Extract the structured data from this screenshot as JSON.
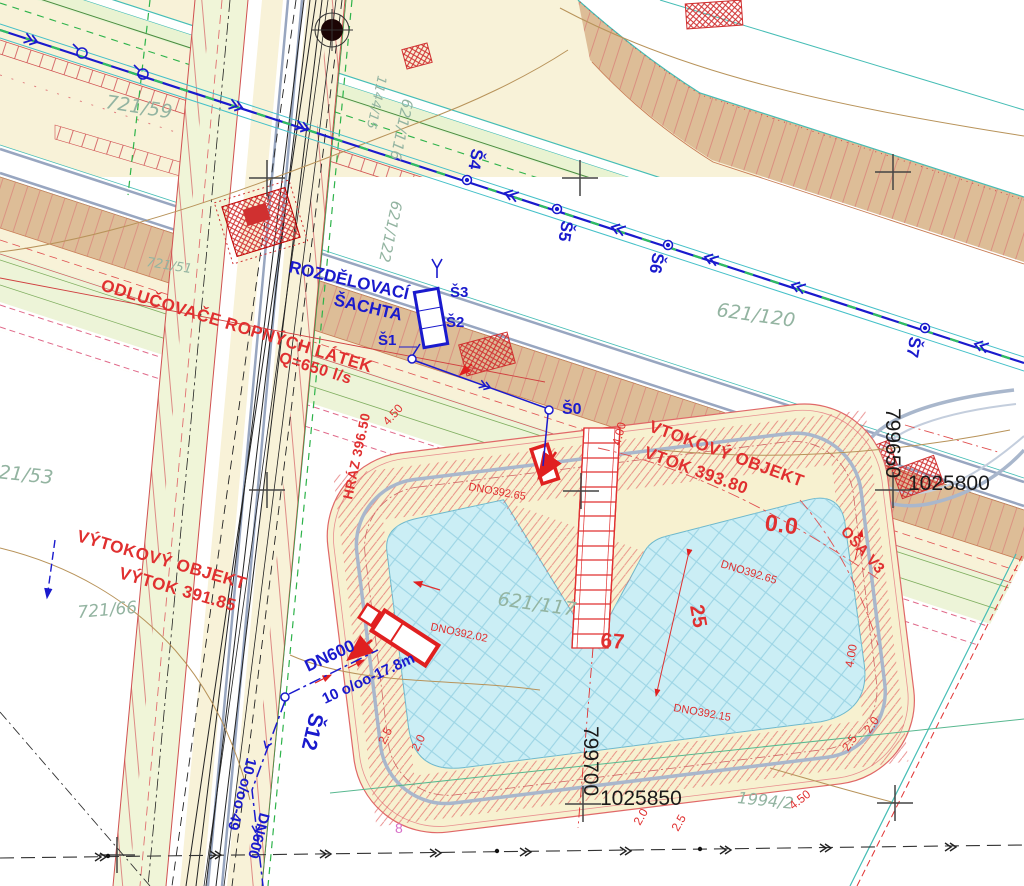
{
  "drawing": {
    "colors": {
      "background": "#ffffff",
      "road_pale_yellow": "#f8f2d8",
      "road_pale_green": "#edf4d8",
      "embankment_tan": "#ddbd97",
      "basin_water": "#cbeef5",
      "basin_hatch": "#9bd4e4",
      "pipe_blue": "#1a1acd",
      "design_red": "#e03030",
      "parcel_green": "#93b4a1",
      "contour_tan": "#b8935a",
      "teal_line": "#45bdb5",
      "grid_black": "#333333"
    },
    "parcels": [
      {
        "text": "721/59"
      },
      {
        "text": "721/51"
      },
      {
        "text": "721/53"
      },
      {
        "text": "721/66"
      },
      {
        "text": "1144/15"
      },
      {
        "text": "621/116"
      },
      {
        "text": "621/122"
      },
      {
        "text": "621/120"
      },
      {
        "text": "621/117"
      },
      {
        "text": "1994/2"
      },
      {
        "text": "8"
      }
    ],
    "shafts": [
      {
        "text": "Š4"
      },
      {
        "text": "Š5"
      },
      {
        "text": "Š6"
      },
      {
        "text": "Š7"
      },
      {
        "text": "Š3"
      },
      {
        "text": "Š2"
      },
      {
        "text": "Š1"
      },
      {
        "text": "Š0"
      },
      {
        "text": "Š12"
      }
    ],
    "blue_notes": [
      {
        "text": "ROZDĚLOVACÍ"
      },
      {
        "text": "ŠACHTA"
      },
      {
        "text": "DN600"
      },
      {
        "text": "10 o/oo-17.8m"
      },
      {
        "text": "10 o/oo-49"
      },
      {
        "text": "DN600"
      }
    ],
    "red_notes": [
      {
        "text": "ODLUČOVAČE ROPNÝCH LÁTEK"
      },
      {
        "text": "Q=650 l/s"
      },
      {
        "text": "VTOKOVÝ OBJEKT"
      },
      {
        "text": "VTOK 393.80"
      },
      {
        "text": "VÝTOKOVÝ OBJEKT"
      },
      {
        "text": "VÝTOK 391.85"
      },
      {
        "text": "HRÁZ 396.50"
      },
      {
        "text": "0.0"
      },
      {
        "text": "OSA V3"
      },
      {
        "text": "25"
      },
      {
        "text": "67"
      },
      {
        "text": "DNO392.65"
      },
      {
        "text": "DNO392.65"
      },
      {
        "text": "DNO392.02"
      },
      {
        "text": "DNO392.15"
      }
    ],
    "dims": [
      {
        "text": "4.50"
      },
      {
        "text": "4.00"
      },
      {
        "text": "4.00"
      },
      {
        "text": "2.5"
      },
      {
        "text": "2.0"
      },
      {
        "text": "4.50"
      },
      {
        "text": "2.5"
      },
      {
        "text": "2.0"
      },
      {
        "text": "2.0"
      },
      {
        "text": "2.5"
      }
    ],
    "coords": [
      {
        "text": "799650"
      },
      {
        "text": "1025800"
      },
      {
        "text": "799700"
      },
      {
        "text": "1025850"
      }
    ]
  }
}
